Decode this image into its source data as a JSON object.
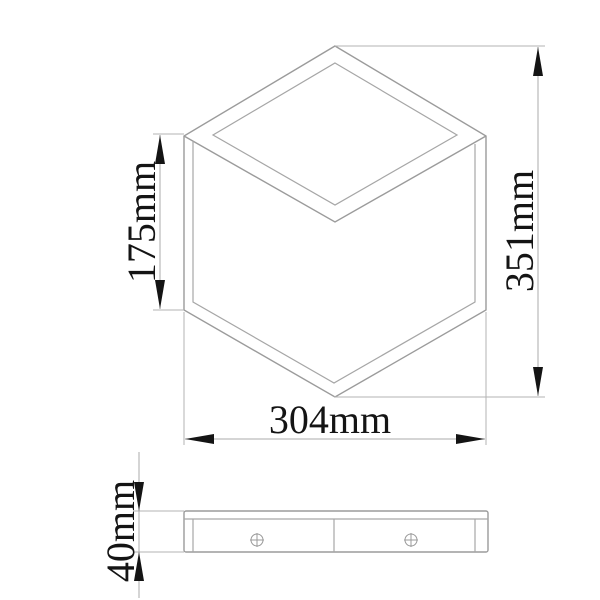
{
  "drawing": {
    "kind": "technical-dimension-drawing",
    "background_color": "#ffffff",
    "outline_color": "#9b9b9b",
    "dimension_line_color": "#ababab",
    "arrow_color": "#141414",
    "text_color": "#141414",
    "views": {
      "front": {
        "description": "isometric cube front view with frame borders"
      },
      "side": {
        "description": "side profile slab",
        "screw_count": 2
      }
    },
    "dimensions": {
      "front_height": {
        "label": "175mm",
        "value": 175,
        "unit": "mm"
      },
      "total_height": {
        "label": "351mm",
        "value": 351,
        "unit": "mm"
      },
      "total_width": {
        "label": "304mm",
        "value": 304,
        "unit": "mm"
      },
      "depth": {
        "label": "40mm",
        "value": 40,
        "unit": "mm"
      }
    }
  }
}
